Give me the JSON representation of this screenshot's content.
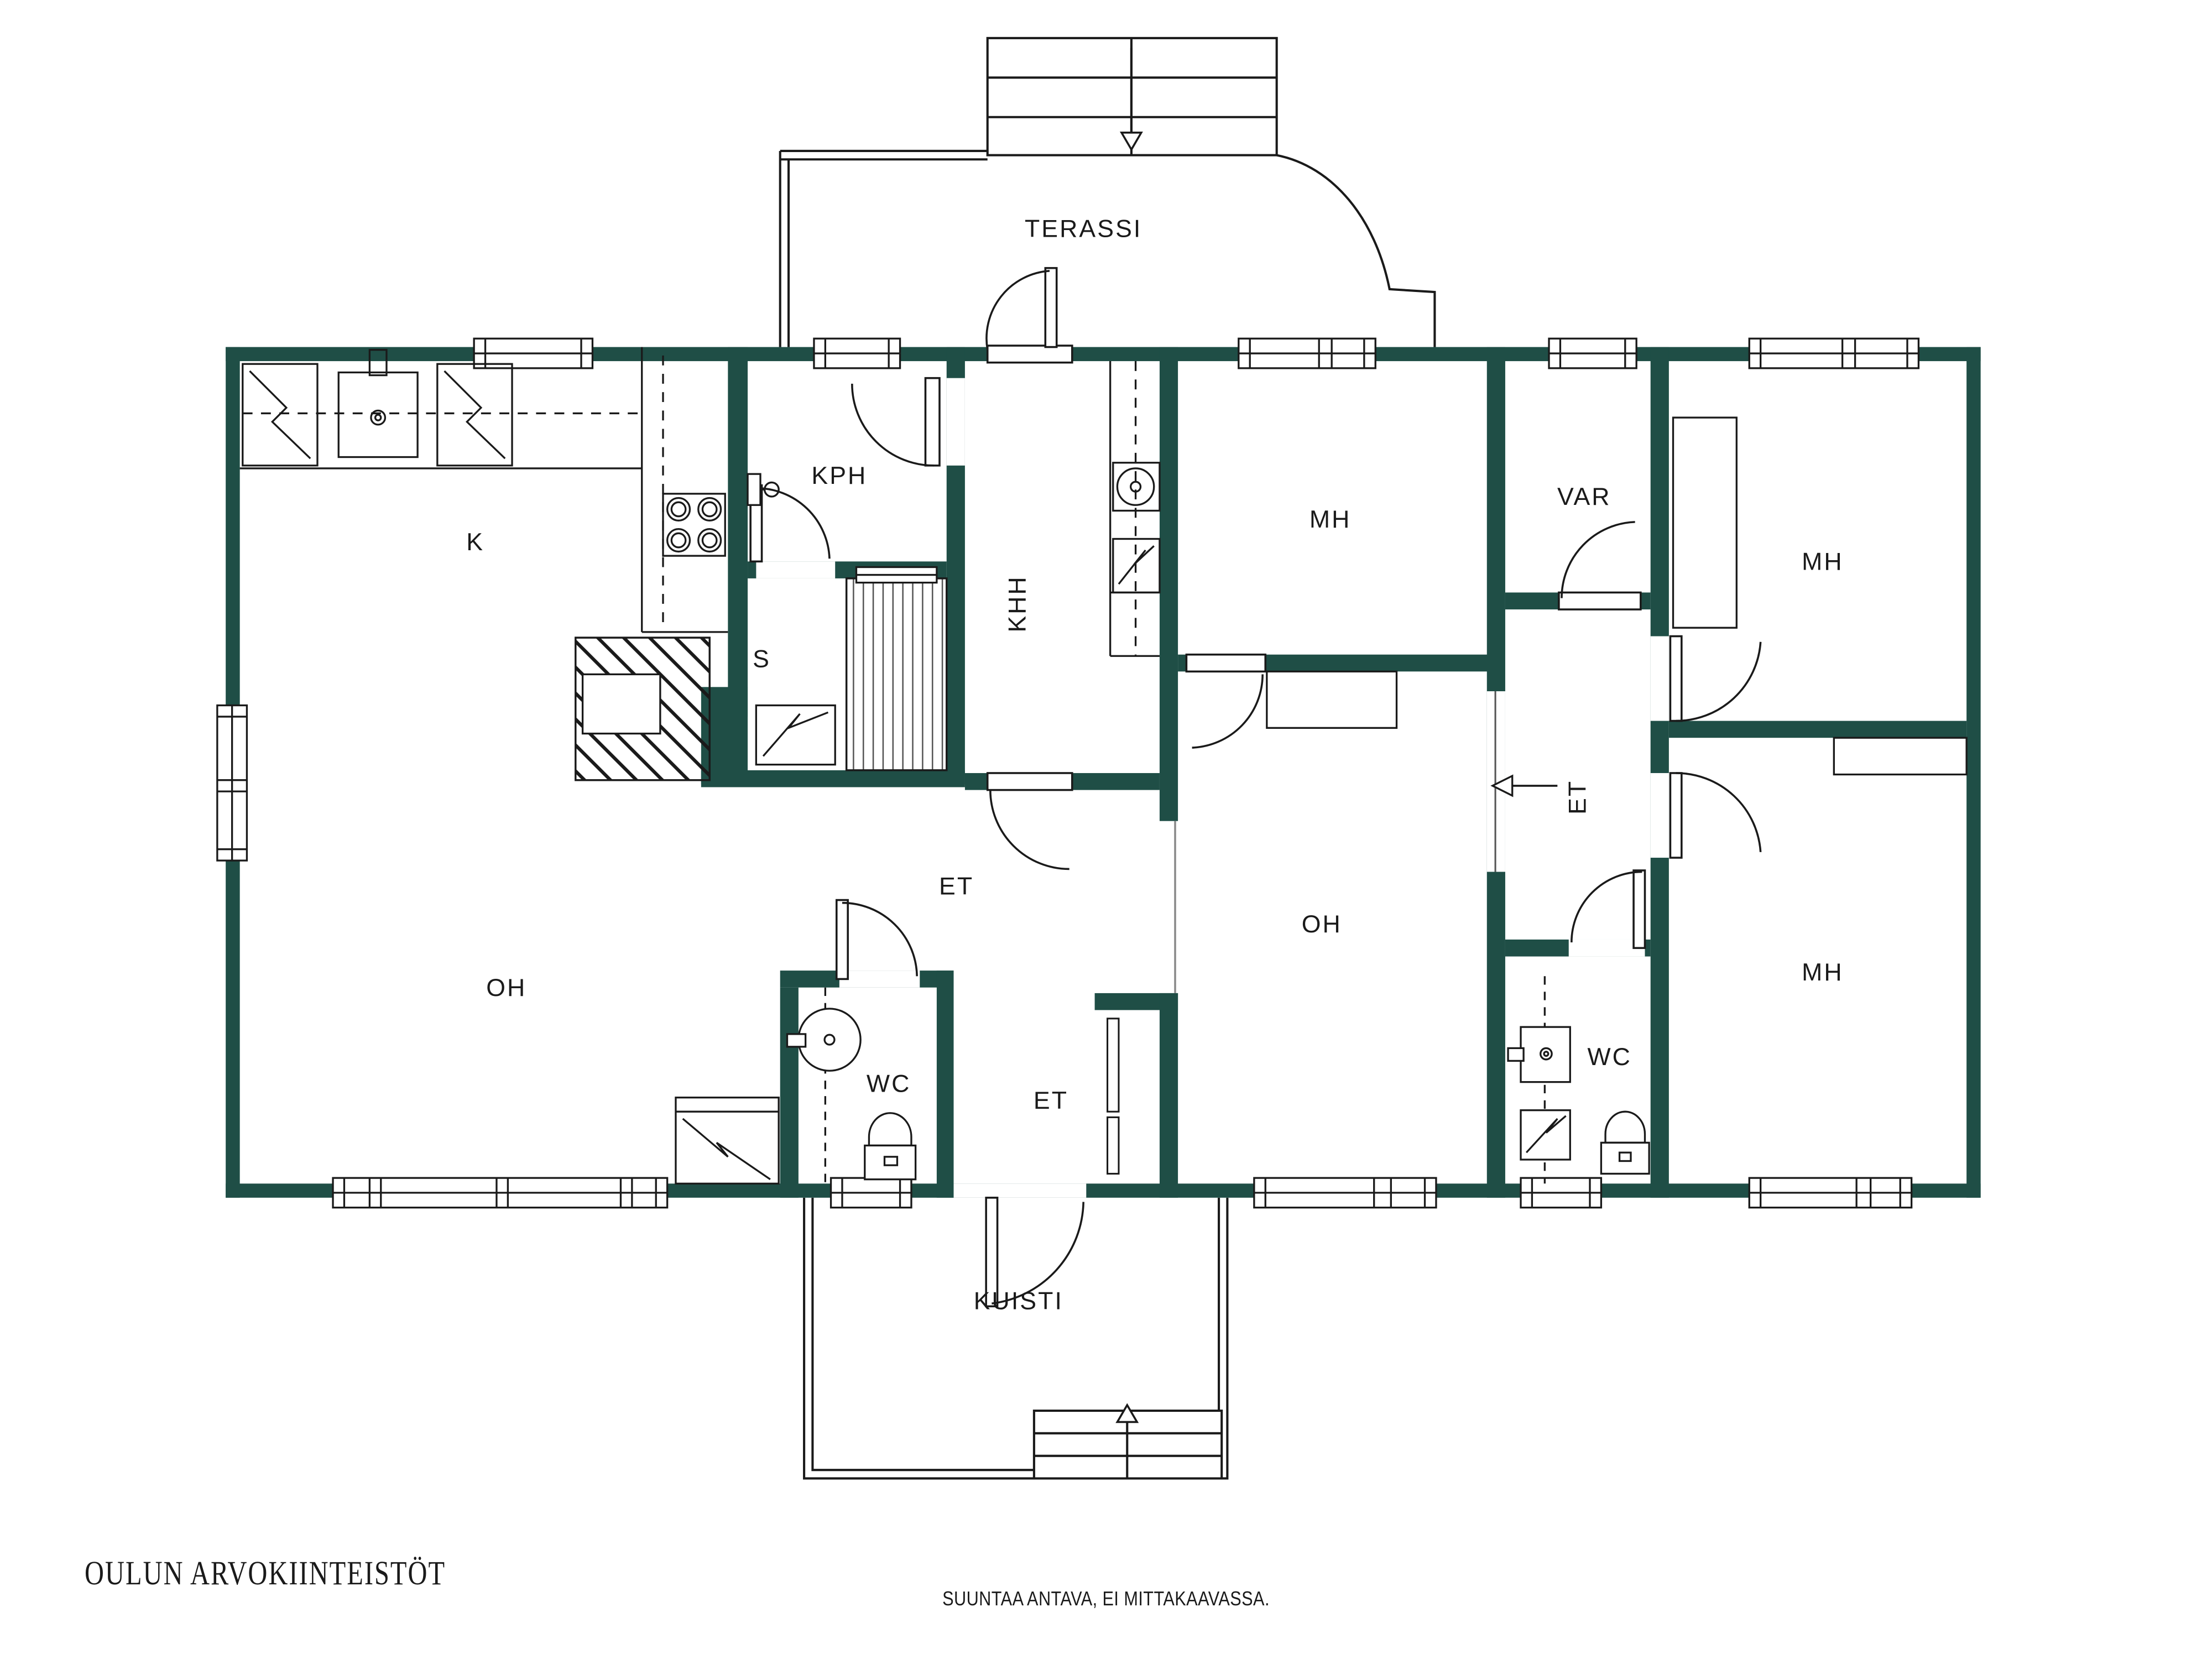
{
  "branding": {
    "logo": "OULUN ARVOKIINTEISTÖT",
    "disclaimer": "SUUNTAA ANTAVA, EI MITTAKAAVASSA."
  },
  "colors": {
    "wall": "#1f4e46",
    "line": "#1a1a1a",
    "thin_line": "#8a8a8a",
    "logo": "#1b4f52",
    "background": "#ffffff"
  },
  "rooms": [
    {
      "label": "TERASSI"
    },
    {
      "label": "K"
    },
    {
      "label": "KPH"
    },
    {
      "label": "S"
    },
    {
      "label": "KHH"
    },
    {
      "label": "MH"
    },
    {
      "label": "VAR"
    },
    {
      "label": "MH"
    },
    {
      "label": "ET"
    },
    {
      "label": "ET"
    },
    {
      "label": "OH"
    },
    {
      "label": "OH"
    },
    {
      "label": "WC"
    },
    {
      "label": "ET"
    },
    {
      "label": "WC"
    },
    {
      "label": "MH"
    },
    {
      "label": "KUISTI"
    }
  ],
  "icons": {
    "stairs_down": "terrace exit steps with down arrow",
    "stairs_up": "porch entry steps with up arrow",
    "entry_arrow": "entry direction arrow",
    "stove": "4-burner stove",
    "sink": "kitchen sink",
    "fridge": "refrigerator",
    "freezer": "freezer",
    "washing_machine": "washing machine",
    "fireplace": "fireplace",
    "sauna_heater": "sauna heater",
    "toilet": "toilet seat",
    "washbasin": "wash basin",
    "chimney": "masonry chimney block",
    "sauna_benches": "sauna benches"
  }
}
